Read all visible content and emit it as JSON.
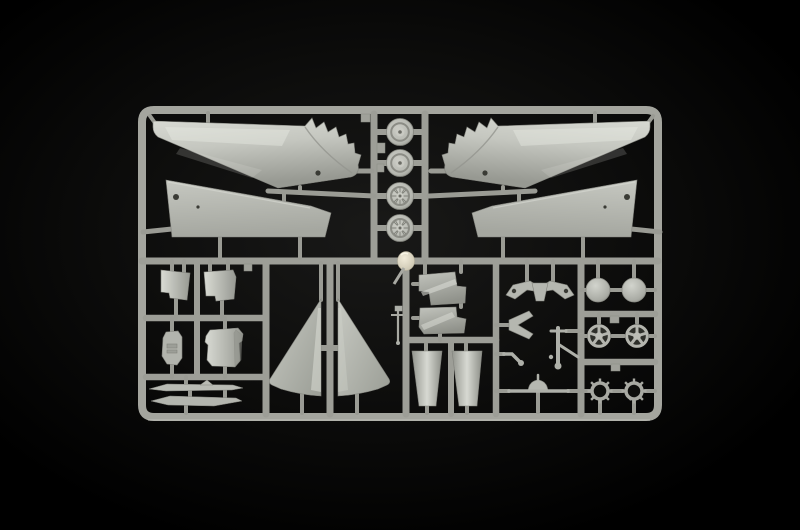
{
  "scene": {
    "title": "Grey plastic model-kit sprue with aircraft parts photographed on a black background",
    "type": "product photograph",
    "subject": "injection-molded polystyrene sprue (runner frame) holding unassembled aircraft model parts",
    "background": "black studio backdrop with subtle vignette",
    "plastic_color_name": "light grey styrene"
  },
  "colors": {
    "background": "#000000",
    "vignette_center": "#191918",
    "vignette_mid": "#0d0d0c",
    "runner": "#a4a59e",
    "runner_dark": "#8f908a",
    "runner_highlight": "#c3c4bd",
    "part_light": "#d9dbd4",
    "part_mid": "#b5b7b0",
    "part_dark": "#979992",
    "sheen": "#eaebe5",
    "recess": "#7d7e77",
    "hole": "#3a3b35",
    "void": "#2e2f2a",
    "ring_center": "#0e0e0c",
    "mold_node": "#f2ecda",
    "mold_node_edge": "#c9c3ae"
  },
  "sprue": {
    "frame_shape": "rounded rectangle runner frame",
    "sections": [
      "upper wing halves with serrated flap edges (left and right)",
      "lower wing panels (left and right)",
      "center column of four main wheel halves",
      "access doors, bay panels and probes (lower left)",
      "vertical fin halves (lower center)",
      "fuselage spine sections and intake ducts",
      "landing gear small parts",
      "hub discs, spoked wheel hubs, turbine rings (lower right)"
    ],
    "parts": [
      {
        "name": "upper wing half, serrated flap edge",
        "qty": 2
      },
      {
        "name": "lower wing panel",
        "qty": 2
      },
      {
        "name": "main wheel half",
        "qty": 4
      },
      {
        "name": "curved access door",
        "qty": 2
      },
      {
        "name": "equipment bay panel",
        "qty": 2
      },
      {
        "name": "slender probe / pylon",
        "qty": 2
      },
      {
        "name": "vertical fin half",
        "qty": 2
      },
      {
        "name": "fuselage spine section",
        "qty": 2
      },
      {
        "name": "tapered intake duct",
        "qty": 2
      },
      {
        "name": "landing gear yoke",
        "qty": 1
      },
      {
        "name": "nose gear fork",
        "qty": 1
      },
      {
        "name": "main gear strut",
        "qty": 1
      },
      {
        "name": "gear retractor link",
        "qty": 1
      },
      {
        "name": "axle bar with dome fairing",
        "qty": 1
      },
      {
        "name": "antenna probe",
        "qty": 1
      },
      {
        "name": "wheel hub cover disc",
        "qty": 2
      },
      {
        "name": "spoked wheel hub",
        "qty": 2
      },
      {
        "name": "turbine / afterburner ring",
        "qty": 2
      }
    ],
    "mold_node": "cream-coloured shiny sprue node at centre divider"
  }
}
